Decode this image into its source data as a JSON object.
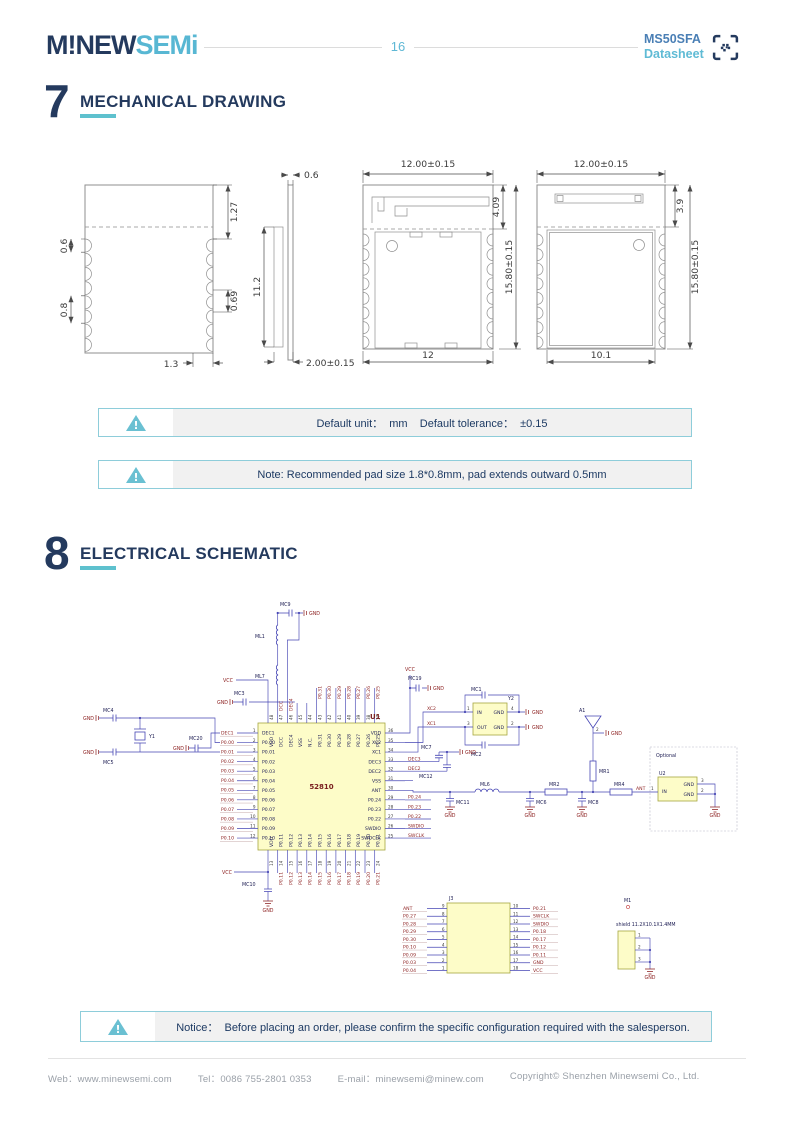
{
  "colors": {
    "navy": "#243A5E",
    "teal": "#5EC1CE",
    "light_blue": "#58B7D3",
    "steel_blue": "#4A7FB5",
    "net_red": "#8B1E1E",
    "wire_blue": "#4646B4"
  },
  "header": {
    "logo_primary": "M!NEW",
    "logo_secondary": "SEMi",
    "page_number": "16",
    "product": "MS50SFA",
    "doc_type": "Datasheet"
  },
  "section7": {
    "number": "7",
    "title": "MECHANICAL DRAWING"
  },
  "section8": {
    "number": "8",
    "title": "ELECTRICAL SCHEMATIC"
  },
  "mech": {
    "view1": {
      "d06": "0.6",
      "d08": "0.8",
      "d127": "1.27",
      "d069": "0.69",
      "d13": "1.3"
    },
    "view2": {
      "d06": "0.6",
      "d112": "11.2",
      "d200": "2.00±0.15"
    },
    "view3": {
      "top": "12.00±0.15",
      "d409": "4.09",
      "right": "15.80±0.15",
      "bottom": "12"
    },
    "view4": {
      "top": "12.00±0.15",
      "d39": "3.9",
      "right": "15.80±0.15",
      "bottom": "10.1"
    }
  },
  "notices": [
    {
      "text": "Default unit：  mm    Default tolerance：  ±0.15"
    },
    {
      "text": "Note: Recommended pad size 1.8*0.8mm, pad extends outward 0.5mm"
    },
    {
      "text": "Notice：  Before placing an order, please confirm the specific configuration required with the salesperson."
    }
  ],
  "footer": {
    "items": [
      {
        "label": "Web：",
        "value": "www.minewsemi.com"
      },
      {
        "label": "Tel：",
        "value": "0086 755-2801 0353"
      },
      {
        "label": "E-mail：",
        "value": "minewsemi@minew.com"
      },
      {
        "label": "",
        "value": "Copyright© Shenzhen Minewsemi Co., Ltd."
      }
    ]
  },
  "schematic": {
    "u1": {
      "left_pins": [
        {
          "n": "1",
          "name": "DEC1"
        },
        {
          "n": "2",
          "name": "P0.00"
        },
        {
          "n": "3",
          "name": "P0.01"
        },
        {
          "n": "4",
          "name": "P0.02"
        },
        {
          "n": "5",
          "name": "P0.03"
        },
        {
          "n": "6",
          "name": "P0.04"
        },
        {
          "n": "7",
          "name": "P0.05"
        },
        {
          "n": "8",
          "name": "P0.06"
        },
        {
          "n": "9",
          "name": "P0.07"
        },
        {
          "n": "10",
          "name": "P0.08"
        },
        {
          "n": "11",
          "name": "P0.09"
        },
        {
          "n": "12",
          "name": "P0.10"
        }
      ],
      "right_pins": [
        {
          "n": "36",
          "name": "VDD"
        },
        {
          "n": "35",
          "name": "XC2"
        },
        {
          "n": "34",
          "name": "XC1"
        },
        {
          "n": "33",
          "name": "DEC3"
        },
        {
          "n": "32",
          "name": "DEC2"
        },
        {
          "n": "31",
          "name": "VSS"
        },
        {
          "n": "30",
          "name": "ANT"
        },
        {
          "n": "29",
          "name": "P0.24"
        },
        {
          "n": "28",
          "name": "P0.23"
        },
        {
          "n": "27",
          "name": "P0.22"
        },
        {
          "n": "26",
          "name": "SWDIO"
        },
        {
          "n": "25",
          "name": "SWDCLK"
        }
      ],
      "top_pins": [
        {
          "n": "48",
          "name": "VDD"
        },
        {
          "n": "47",
          "name": "DCC"
        },
        {
          "n": "46",
          "name": "DEC4"
        },
        {
          "n": "45",
          "name": "VSS"
        },
        {
          "n": "44",
          "name": "N.C."
        },
        {
          "n": "43",
          "name": "P0.31"
        },
        {
          "n": "42",
          "name": "P0.30"
        },
        {
          "n": "41",
          "name": "P0.29"
        },
        {
          "n": "40",
          "name": "P0.28"
        },
        {
          "n": "39",
          "name": "P0.27"
        },
        {
          "n": "38",
          "name": "P0.26"
        },
        {
          "n": "37",
          "name": "P0.25"
        }
      ],
      "bottom_pins": [
        {
          "n": "13",
          "name": "VDD"
        },
        {
          "n": "14",
          "name": "P0.11"
        },
        {
          "n": "15",
          "name": "P0.12"
        },
        {
          "n": "16",
          "name": "P0.13"
        },
        {
          "n": "17",
          "name": "P0.14"
        },
        {
          "n": "18",
          "name": "P0.15"
        },
        {
          "n": "19",
          "name": "P0.16"
        },
        {
          "n": "20",
          "name": "P0.17"
        },
        {
          "n": "21",
          "name": "P0.18"
        },
        {
          "n": "22",
          "name": "P0.19"
        },
        {
          "n": "23",
          "name": "P0.20"
        },
        {
          "n": "24",
          "name": "P0.21"
        }
      ]
    },
    "top_nets": [
      "P0.31",
      "P0.30",
      "P0.29",
      "P0.28",
      "P0.27",
      "P0.26",
      "P0.25"
    ],
    "bottom_nets": [
      "P0.11",
      "P0.12",
      "P0.13",
      "P0.14",
      "P0.15",
      "P0.16",
      "P0.17",
      "P0.18",
      "P0.19",
      "P0.20",
      "P0.21"
    ],
    "right_nets_dec": [
      "DEC3",
      "DEC2"
    ],
    "right_nets": [
      "P0.24",
      "P0.23",
      "P0.22",
      "SWDIO",
      "SWCLK"
    ],
    "j3": {
      "left": [
        {
          "n": "9",
          "net": "ANT"
        },
        {
          "n": "8",
          "net": "P0.27"
        },
        {
          "n": "7",
          "net": "P0.28"
        },
        {
          "n": "6",
          "net": "P0.29"
        },
        {
          "n": "5",
          "net": "P0.30"
        },
        {
          "n": "4",
          "net": "P0.10"
        },
        {
          "n": "3",
          "net": "P0.09"
        },
        {
          "n": "2",
          "net": "P0.03"
        },
        {
          "n": "1",
          "net": "P0.04"
        }
      ],
      "right": [
        {
          "n": "10",
          "net": "P0.21"
        },
        {
          "n": "11",
          "net": "SWCLK"
        },
        {
          "n": "12",
          "net": "SWDIO"
        },
        {
          "n": "13",
          "net": "P0.18"
        },
        {
          "n": "14",
          "net": "P0.17"
        },
        {
          "n": "15",
          "net": "P0.12"
        },
        {
          "n": "16",
          "net": "P0.11"
        },
        {
          "n": "17",
          "net": "GND"
        },
        {
          "n": "18",
          "net": "VCC"
        }
      ]
    },
    "m1": {
      "pins": [
        "1",
        "2",
        "3"
      ]
    },
    "y2": {
      "p1": "1",
      "p2": "2",
      "p3": "3",
      "p4": "4",
      "in": "IN",
      "out": "OUT",
      "gnd": "GND"
    },
    "u2": {
      "p1": "1",
      "p2": "2",
      "p3": "3",
      "in": "IN",
      "gnd": "GND"
    },
    "a1_pin2": "2",
    "components": {
      "u1": "U1",
      "chip": "52810",
      "mc1": "MC1",
      "mc2": "MC2",
      "mc3": "MC3",
      "mc4": "MC4",
      "mc5": "MC5",
      "mc6": "MC6",
      "mc7": "MC7",
      "mc8": "MC8",
      "mc9": "MC9",
      "mc10": "MC10",
      "mc11": "MC11",
      "mc12": "MC12",
      "mc19": "MC19",
      "mc20": "MC20",
      "ml1": "ML1",
      "ml6": "ML6",
      "ml7": "ML7",
      "mr1": "MR1",
      "mr2": "MR2",
      "mr4": "MR4",
      "y1": "Y1",
      "y2": "Y2",
      "a1": "A1",
      "u2": "U2",
      "j3": "J3",
      "m1": "M1",
      "optional": "Optional",
      "shield": "shield 11.2X10.1X1.4MM",
      "vcc": "VCC",
      "gnd": "GND",
      "ant": "ANT",
      "xc1": "XC1",
      "xc2": "XC2",
      "dcc": "DCC",
      "dec4": "DEC4"
    }
  }
}
